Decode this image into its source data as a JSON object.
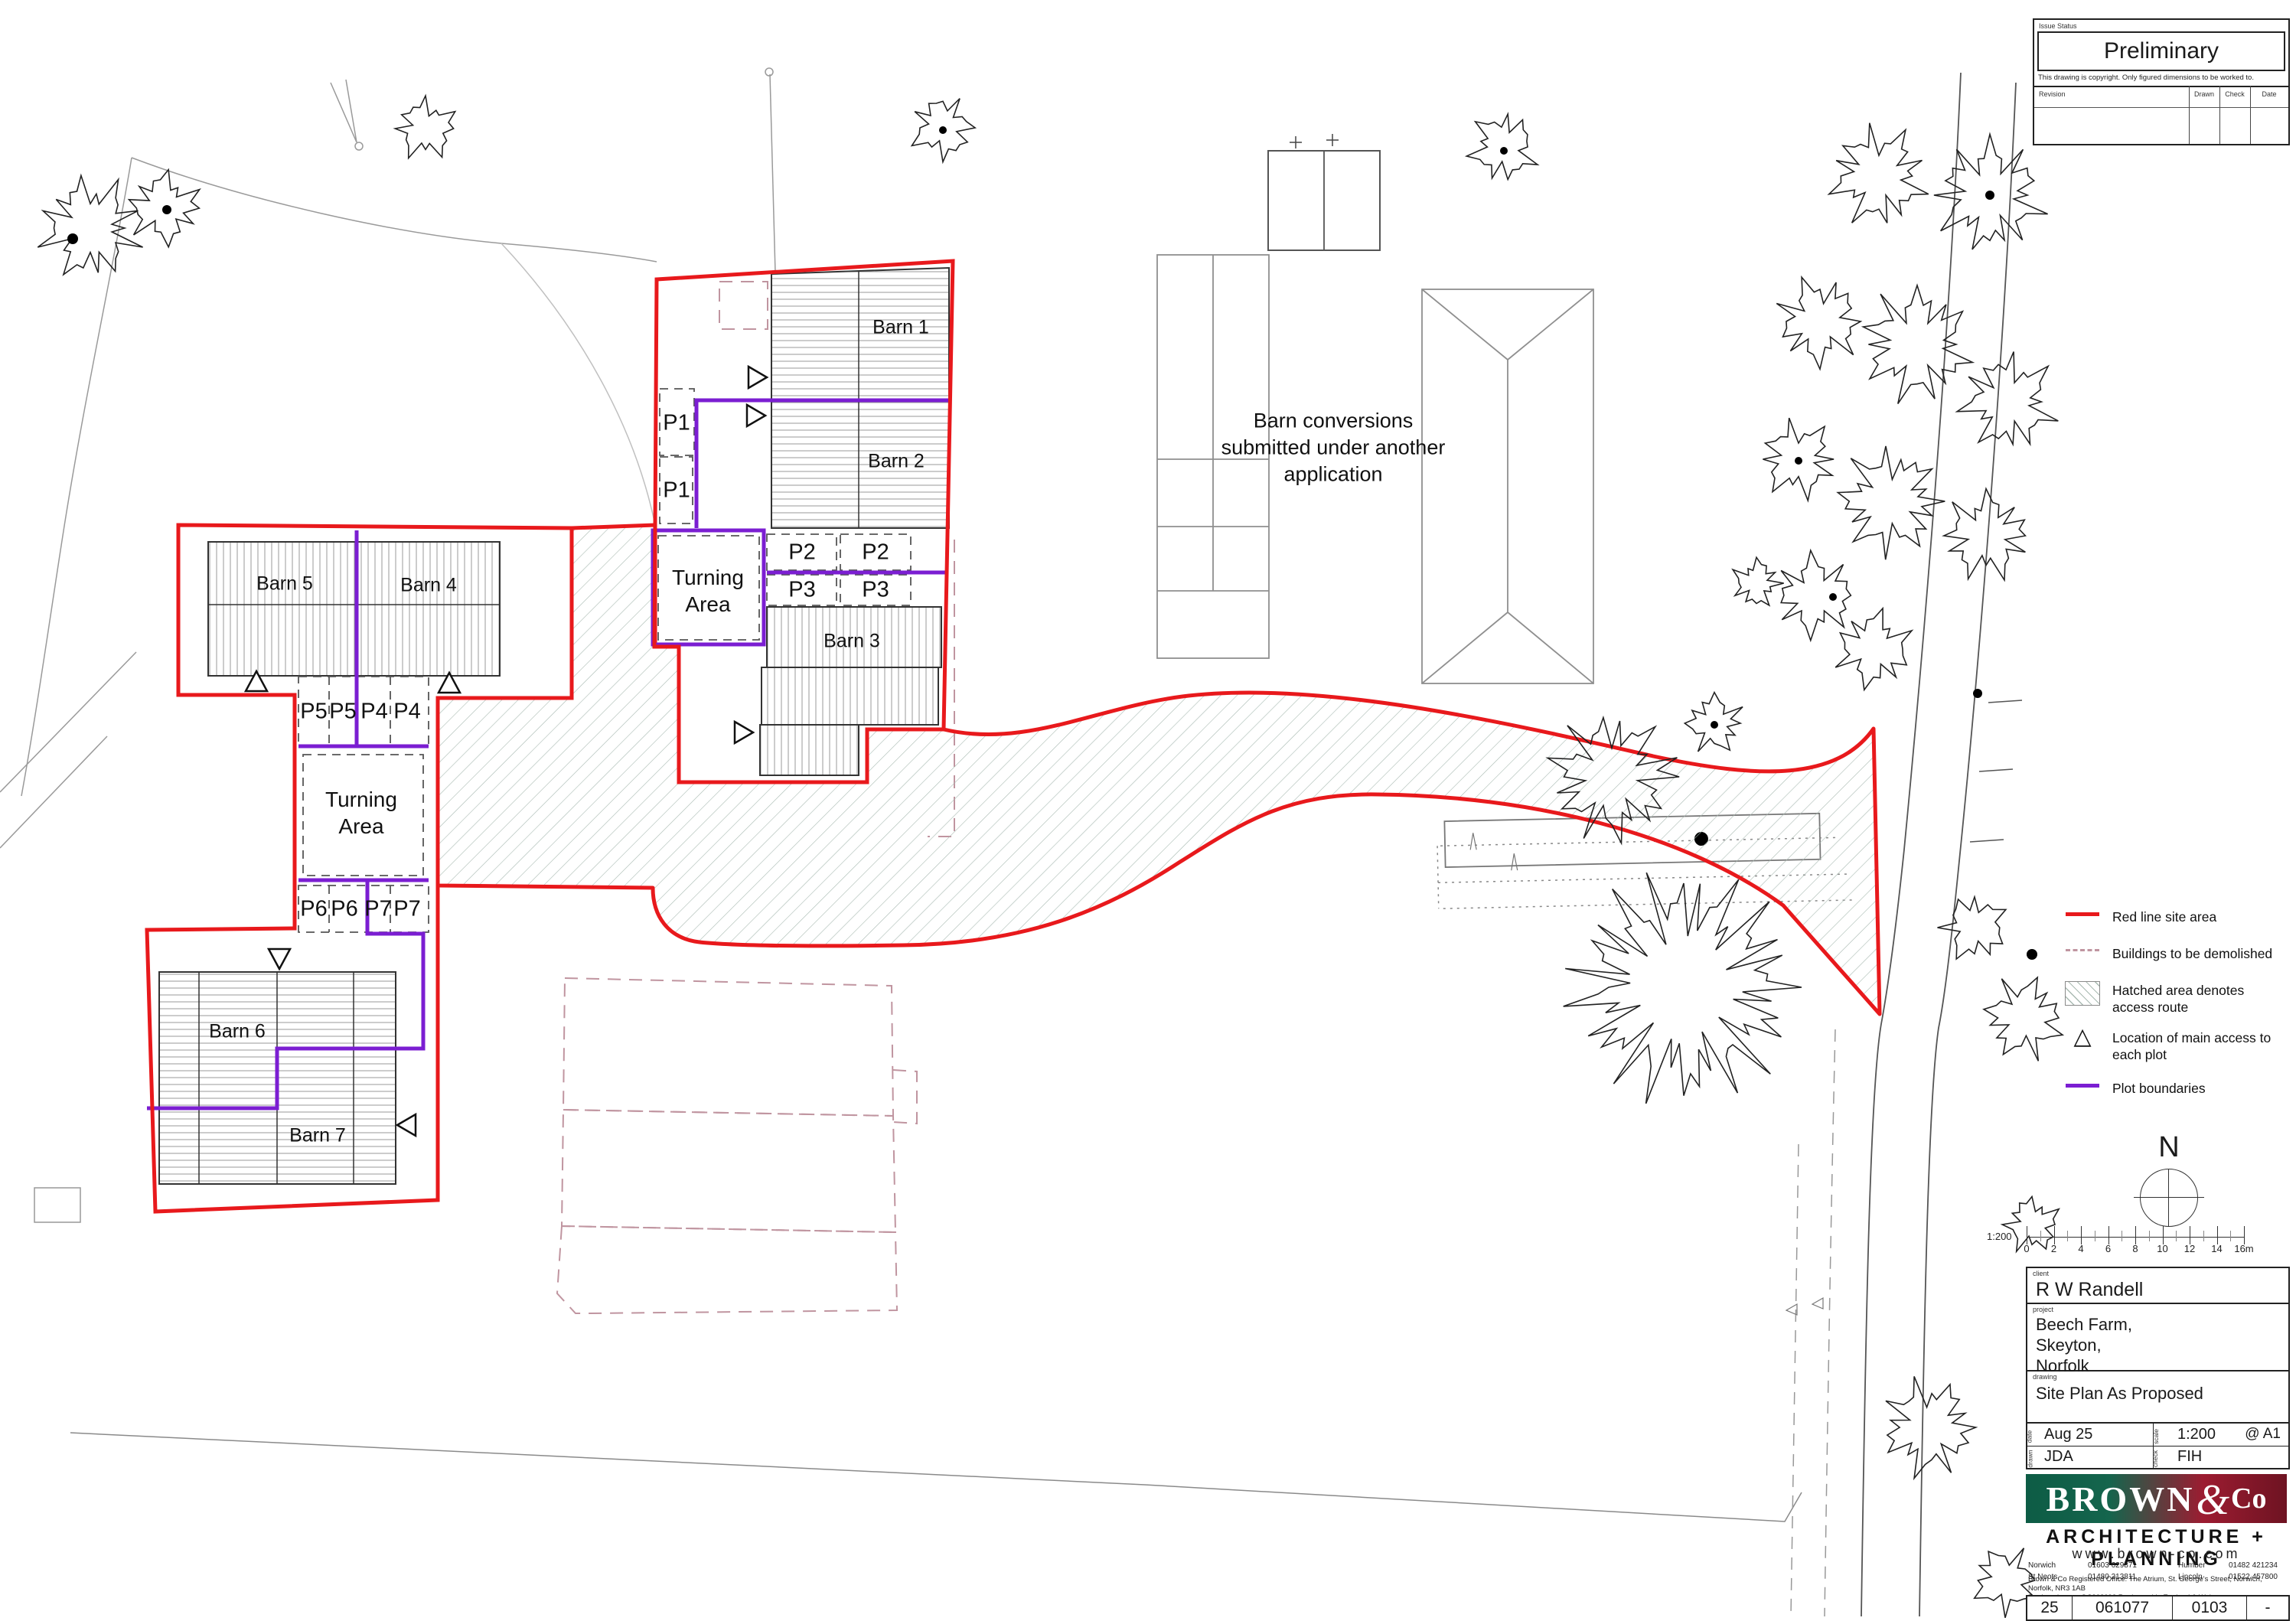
{
  "issue_block": {
    "label": "Issue Status",
    "status": "Preliminary",
    "copyright": "This drawing is copyright.  Only figured dimensions to be worked to.",
    "revision_label": "Revision",
    "drawn_label": "Drawn",
    "check_label": "Check",
    "date_label": "Date"
  },
  "map": {
    "barn1": "Barn 1",
    "barn2": "Barn 2",
    "barn3": "Barn 3",
    "barn4": "Barn 4",
    "barn5": "Barn 5",
    "barn6": "Barn 6",
    "barn7": "Barn 7",
    "p1": "P1",
    "p2": "P2",
    "p3": "P3",
    "p4": "P4",
    "p5": "P5",
    "p6": "P6",
    "p7": "P7",
    "turning_area": "Turning Area",
    "note": "Barn conversions submitted under another application"
  },
  "legend": {
    "items": [
      {
        "symbol": "red-line",
        "label": "Red line site area"
      },
      {
        "symbol": "dashed-line",
        "label": "Buildings to be demolished"
      },
      {
        "symbol": "hatch-swatch",
        "label": "Hatched area denotes access route"
      },
      {
        "symbol": "triangle",
        "label": "Location of main access to each plot"
      },
      {
        "symbol": "purple-line",
        "label": "Plot boundaries"
      }
    ]
  },
  "north_label": "N",
  "scale_bar": {
    "ratio": "1:200",
    "ticks": [
      "0",
      "2",
      "4",
      "6",
      "8",
      "10",
      "12",
      "14",
      "16m"
    ]
  },
  "title_block": {
    "client_label": "client",
    "client": "R W Randell",
    "project_label": "project",
    "project_line1": "Beech Farm,",
    "project_line2": "Skeyton,",
    "project_line3": "Norfolk",
    "drawing_label": "drawing",
    "drawing": "Site Plan As Proposed",
    "date_label": "date",
    "date": "Aug 25",
    "scale_label": "scale",
    "scale": "1:200",
    "paper": "@ A1",
    "drawn_label": "drawn",
    "drawn": "JDA",
    "check_label": "check",
    "check": "FIH"
  },
  "logo": {
    "brand": "BROWN",
    "amp": "&",
    "co": "Co",
    "tagline": "ARCHITECTURE + PLANNING",
    "website": "www.brown-co.com",
    "offices": [
      {
        "name": "Norwich",
        "phone": "01603 629871"
      },
      {
        "name": "St Neots",
        "phone": "01480 213811"
      },
      {
        "name": "Humber",
        "phone": "01482 421234"
      },
      {
        "name": "Lincoln",
        "phone": "01522 457800"
      }
    ],
    "registered": "Brown & Co Registered Office: The Atrium, St. George's Street, Norwich, Norfolk, NR3 1AB",
    "registration": "Registration no: OC302092  Registered in England & Wales"
  },
  "drawing_numbers": [
    "25",
    "061077",
    "0103",
    "-"
  ],
  "colors": {
    "red_line": "#e8191c",
    "purple_line": "#7b1ed2",
    "demolish_dash": "#c095a0",
    "hatch": "#a9bab2"
  }
}
